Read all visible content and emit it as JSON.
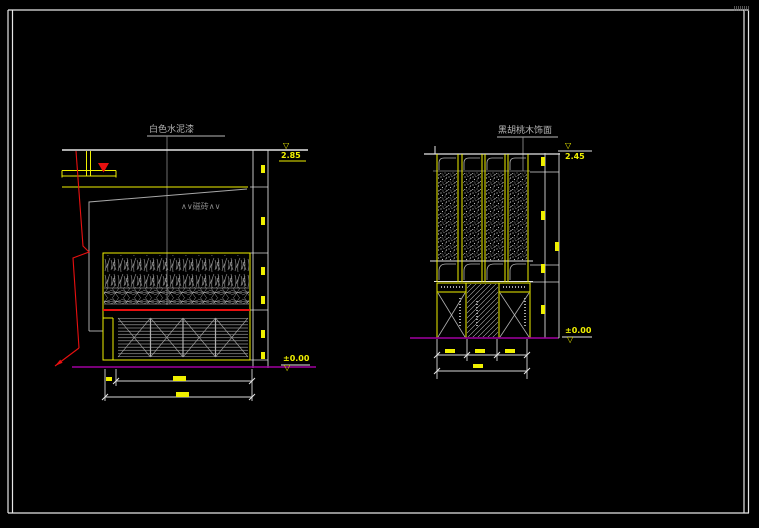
{
  "left_elevation": {
    "finish_label": "白色水泥漆",
    "surface_note": "∧∨磁砖∧∨",
    "top_level": "2.85",
    "ground_level": "±0.00",
    "level_symbol": "▽"
  },
  "right_elevation": {
    "finish_label": "黑胡桃木饰面",
    "top_level": "2.45",
    "ground_level": "±0.00",
    "level_symbol": "▽"
  },
  "colors": {
    "background": "#000000",
    "sheet_border": "#e6e6e6",
    "line_yellow": "#f0f000",
    "line_red": "#e81010",
    "line_magenta": "#a000a0",
    "line_gray": "#9a9a9a",
    "line_white": "#e6e6e6"
  }
}
